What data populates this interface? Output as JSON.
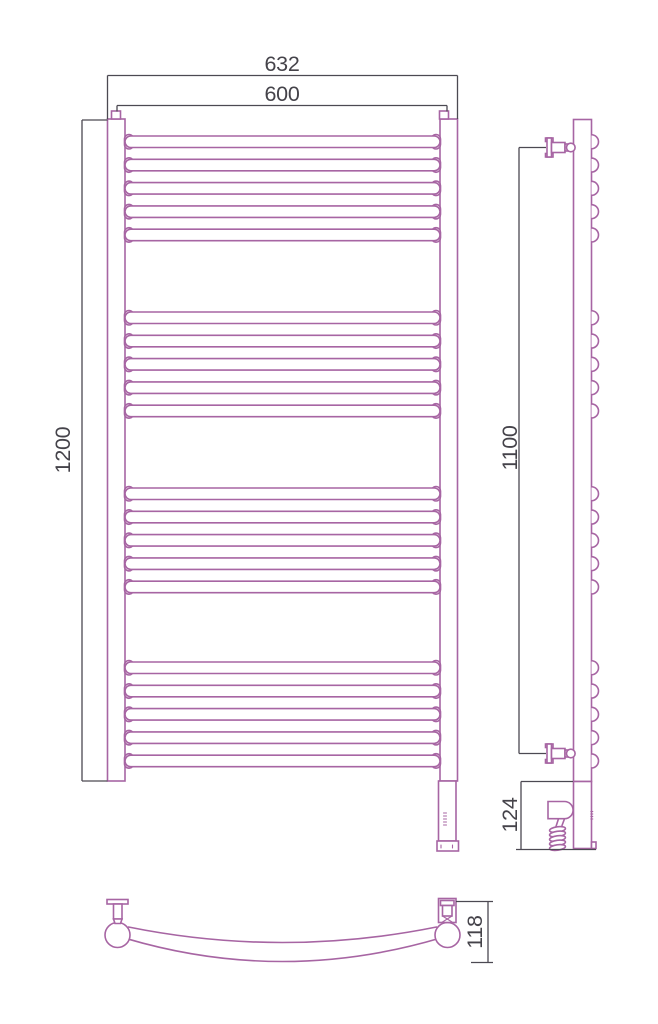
{
  "title": "Heated towel rail technical drawing, three views with dimensions",
  "dimensions": {
    "overall_width": "632",
    "rail_width": "600",
    "overall_height": "1200",
    "mounting_height": "1100",
    "lower_section_height": "124",
    "depth": "118"
  },
  "colors": {
    "product_outline": "#a765a3",
    "dimension_line": "#4c4952",
    "dimension_text": "#45434a",
    "background": "#ffffff"
  },
  "geometry": {
    "bar_group_tops": [
      136,
      312,
      488,
      662
    ],
    "bars_per_group": 5,
    "bar_pitch": 23.3,
    "bar_height": 11.5,
    "bar_left_x": 125,
    "bar_right_x": 440,
    "bar_cap_w": 9,
    "side_bump_x": 591.5,
    "side_bump_r": 7,
    "bracket_centers_y": [
      147.5,
      753.5
    ],
    "coil_loops": 5
  }
}
